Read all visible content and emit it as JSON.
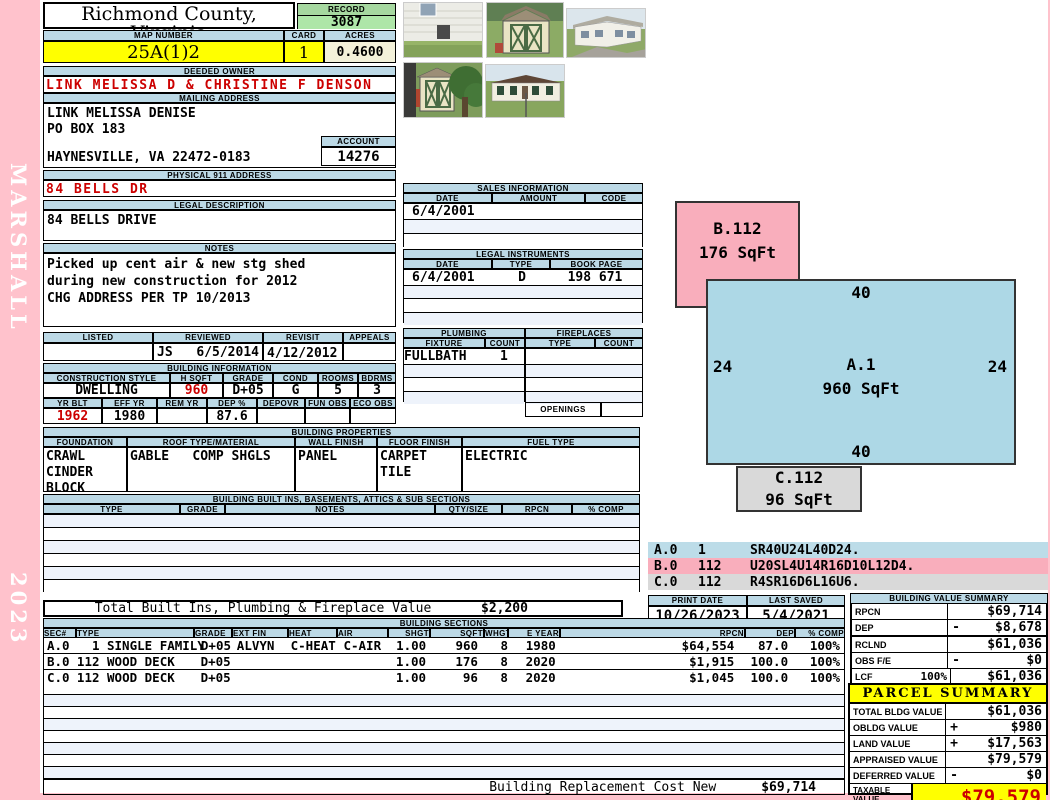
{
  "sidebar": {
    "name": "MARSHALL",
    "year": "2023"
  },
  "header": {
    "county": "Richmond County, Virginia",
    "commissioner": "Commissioner of the Revenue, PO Box 366, Warsaw, VA 22572",
    "record_label": "RECORD",
    "record": "3087",
    "map_number_label": "MAP NUMBER",
    "map_number": "25A(1)2",
    "card_label": "CARD",
    "card": "1",
    "acres_label": "ACRES",
    "acres": "0.4600"
  },
  "owner": {
    "deeded_owner_label": "DEEDED OWNER",
    "deeded_owner": "LINK MELISSA D & CHRISTINE F DENSON",
    "mailing_label": "MAILING ADDRESS",
    "mailing_line1": "LINK MELISSA DENISE",
    "mailing_line2": "PO BOX 183",
    "mailing_line3": "HAYNESVILLE, VA 22472-0183",
    "account_label": "ACCOUNT",
    "account": "14276",
    "physical_label": "PHYSICAL 911 ADDRESS",
    "physical": "84 BELLS DR",
    "legal_label": "LEGAL DESCRIPTION",
    "legal": "84 BELLS DRIVE",
    "notes_label": "NOTES",
    "notes_line1": "Picked up cent air & new stg shed",
    "notes_line2": "during new construction for 2012",
    "notes_line3": "CHG ADDRESS PER TP 10/2013"
  },
  "visits": {
    "listed_label": "LISTED",
    "reviewed_label": "REVIEWED",
    "revisit_label": "REVISIT",
    "appeals_label": "APPEALS",
    "listed": "",
    "reviewed_by": "JS",
    "reviewed_date": "6/5/2014",
    "revisit": "4/12/2012",
    "appeals": ""
  },
  "building_info": {
    "title": "BUILDING INFORMATION",
    "labels1": {
      "style": "CONSTRUCTION STYLE",
      "hsqft": "H SQFT",
      "grade": "GRADE",
      "cond": "COND",
      "rooms": "ROOMS",
      "bdrms": "BDRMS"
    },
    "values1": {
      "style": "DWELLING",
      "hsqft": "960",
      "grade": "D+05",
      "cond": "G",
      "rooms": "5",
      "bdrms": "3"
    },
    "labels2": {
      "yrblt": "YR BLT",
      "effyr": "EFF YR",
      "remyr": "REM YR",
      "dep": "DEP %",
      "depovr": "DEPOVR",
      "funobs": "FUN OBS",
      "ecoobs": "ECO OBS"
    },
    "values2": {
      "yrblt": "1962",
      "effyr": "1980",
      "remyr": "",
      "dep": "87.6",
      "depovr": "",
      "funobs": "",
      "ecoobs": ""
    }
  },
  "building_properties": {
    "title": "BUILDING PROPERTIES",
    "labels": {
      "foundation": "FOUNDATION",
      "roof": "ROOF TYPE/MATERIAL",
      "wall": "WALL FINISH",
      "floor": "FLOOR FINISH",
      "fuel": "FUEL TYPE"
    },
    "foundation_line1": "CRAWL",
    "foundation_line2": "CINDER BLOCK",
    "roof_type": "GABLE",
    "roof_material": "COMP SHGLS",
    "wall": "PANEL",
    "floor_line1": "CARPET",
    "floor_line2": "TILE",
    "fuel": "ELECTRIC"
  },
  "built_ins": {
    "title": "BUILDING BUILT INS, BASEMENTS, ATTICS & SUB SECTIONS",
    "headers": {
      "type": "TYPE",
      "grade": "GRADE",
      "notes": "NOTES",
      "qty": "QTY/SIZE",
      "rpcn": "RPCN",
      "comp": "% COMP"
    },
    "total_label": "Total Built Ins, Plumbing & Fireplace Value",
    "total_value": "$2,200"
  },
  "sales": {
    "title": "SALES INFORMATION",
    "headers": {
      "date": "DATE",
      "amount": "AMOUNT",
      "code": "CODE"
    },
    "rows": [
      {
        "date": "6/4/2001",
        "amount": "",
        "code": ""
      }
    ]
  },
  "legal_instruments": {
    "title": "LEGAL INSTRUMENTS",
    "headers": {
      "date": "DATE",
      "type": "TYPE",
      "book": "BOOK PAGE"
    },
    "rows": [
      {
        "date": "6/4/2001",
        "type": "D",
        "book": "198 671"
      }
    ]
  },
  "plumbing": {
    "title": "PLUMBING",
    "headers": {
      "fixture": "FIXTURE",
      "count": "COUNT"
    },
    "rows": [
      {
        "fixture": "FULLBATH",
        "count": "1"
      }
    ]
  },
  "fireplaces": {
    "title": "FIREPLACES",
    "headers": {
      "type": "TYPE",
      "count": "COUNT"
    },
    "openings_label": "OPENINGS"
  },
  "sketch": {
    "shape_b": {
      "label": "B.112",
      "sqft": "176 SqFt"
    },
    "shape_a": {
      "label": "A.1",
      "sqft": "960 SqFt",
      "dim_top": "40",
      "dim_left": "24",
      "dim_right": "24",
      "dim_bottom": "40"
    },
    "shape_c": {
      "label": "C.112",
      "sqft": "96 SqFt"
    },
    "codes": [
      {
        "sec": "A.0",
        "num": "1",
        "vector": "SR40U24L40D24."
      },
      {
        "sec": "B.0",
        "num": "112",
        "vector": "U20SL4U14R16D10L12D4."
      },
      {
        "sec": "C.0",
        "num": "112",
        "vector": "R4SR16D6L16U6."
      }
    ]
  },
  "meta": {
    "print_date_label": "PRINT DATE",
    "print_date": "10/26/2023",
    "last_saved_label": "LAST SAVED",
    "last_saved": "5/4/2021"
  },
  "building_value_summary": {
    "title": "BUILDING VALUE SUMMARY",
    "rows": [
      {
        "label": "RPCN",
        "pct": "",
        "sign": "",
        "value": "$69,714"
      },
      {
        "label": "DEP",
        "pct": "",
        "sign": "-",
        "value": "$8,678"
      },
      {
        "label": "RCLND",
        "pct": "",
        "sign": "",
        "value": "$61,036"
      },
      {
        "label": "OBS F/E",
        "pct": "",
        "sign": "-",
        "value": "$0"
      },
      {
        "label": "LCF",
        "pct": "100%",
        "sign": "",
        "value": "$61,036"
      }
    ]
  },
  "building_sections": {
    "title": "BUILDING SECTIONS",
    "headers": {
      "sec": "SEC#",
      "type": "TYPE",
      "grade": "GRADE",
      "ext": "EXT FIN",
      "heat": "HEAT",
      "air": "AIR",
      "shgt": "SHGT",
      "sqft": "SQFT",
      "whgt": "WHGT",
      "eyear": "E YEAR",
      "rpcn": "RPCN",
      "dep": "DEP",
      "comp": "% COMP"
    },
    "rows": [
      {
        "sec": "A.0",
        "type": "  1 SINGLE FAMILY",
        "grade": "D+05",
        "ext": "ALVYN",
        "heat": "C-HEAT",
        "air": "C-AIR",
        "shgt": "1.00",
        "sqft": "960",
        "whgt": "8",
        "eyear": "1980",
        "rpcn": "$64,554",
        "dep": "87.0",
        "comp": "100%"
      },
      {
        "sec": "B.0",
        "type": "112 WOOD DECK",
        "grade": "D+05",
        "ext": "",
        "heat": "",
        "air": "",
        "shgt": "1.00",
        "sqft": "176",
        "whgt": "8",
        "eyear": "2020",
        "rpcn": "$1,915",
        "dep": "100.0",
        "comp": "100%"
      },
      {
        "sec": "C.0",
        "type": "112 WOOD DECK",
        "grade": "D+05",
        "ext": "",
        "heat": "",
        "air": "",
        "shgt": "1.00",
        "sqft": "96",
        "whgt": "8",
        "eyear": "2020",
        "rpcn": "$1,045",
        "dep": "100.0",
        "comp": "100%"
      }
    ],
    "footer_label": "Building Replacement Cost New",
    "footer_value": "$69,714"
  },
  "parcel_summary": {
    "title": "PARCEL SUMMARY",
    "rows": [
      {
        "label": "TOTAL BLDG VALUE",
        "sign": "",
        "value": "$61,036"
      },
      {
        "label": "OBLDG VALUE",
        "sign": "+",
        "value": "$980"
      },
      {
        "label": "LAND VALUE",
        "sign": "+",
        "value": "$17,563"
      },
      {
        "label": "APPRAISED VALUE",
        "sign": "",
        "value": "$79,579"
      },
      {
        "label": "DEFERRED VALUE",
        "sign": "-",
        "value": "$0"
      }
    ],
    "taxable_label1": "TAXABLE",
    "taxable_label2": "VALUE",
    "taxable_value": "$79,579"
  },
  "photos": {
    "p1": "house-side-view",
    "p2": "storage-shed",
    "p3": "house-angle-view",
    "p4": "shed-and-tree",
    "p5": "house-front-view"
  },
  "colors": {
    "page_pink": "#FFC2CC",
    "header_bar_blue": "#BCD9E6",
    "record_green": "#AEE6A8",
    "highlight_yellow": "#FFFF00",
    "acres_cream": "#F3F1D9",
    "alert_red": "#CC0000",
    "sketch_blue": "#ADD8E6",
    "sketch_pink": "#F9AEBC",
    "sketch_gray": "#D9D9D9"
  }
}
